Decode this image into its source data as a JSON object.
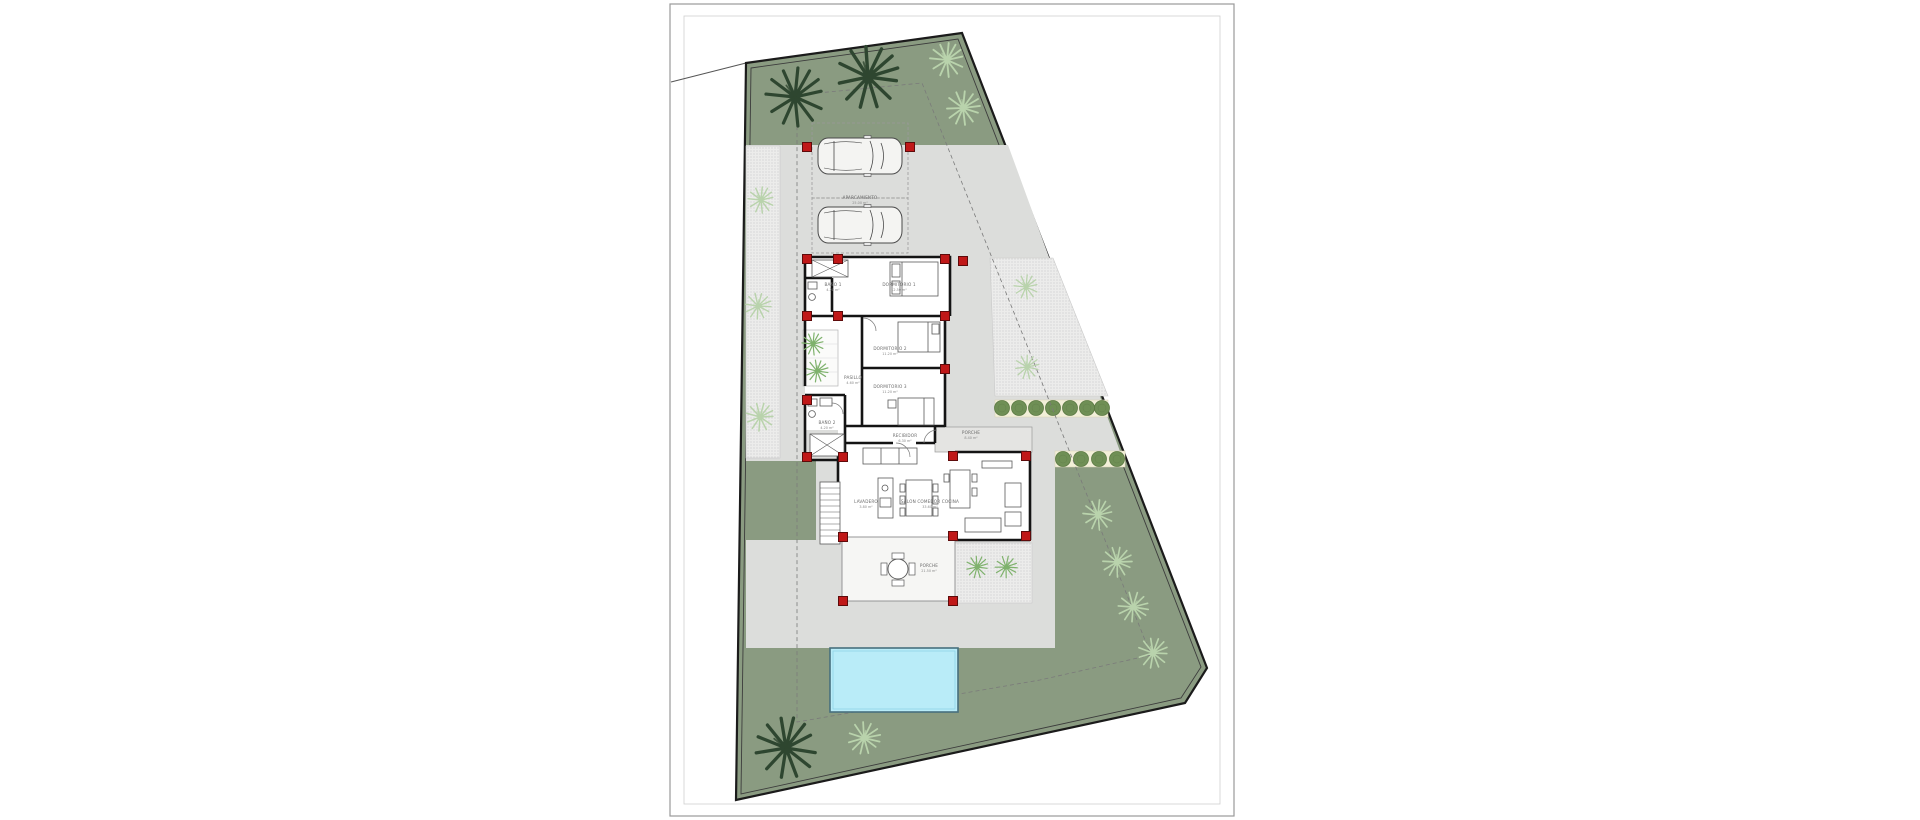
{
  "drawing": {
    "kind_label": "villa site plan",
    "colors": {
      "paper": "#ffffff",
      "lawn": "#8a9b81",
      "paved": "#dcdddb",
      "hatch_bg": "#ececeb",
      "hatch_dot": "#bdbdbd",
      "pool_water": "#b9ecf8",
      "pool_edge": "#47707e",
      "boundary": "#1b1b1b",
      "wall": "#141414",
      "column_red": "#c01818",
      "tree_dark": "#2e4630",
      "tree_light": "#b9d3ac",
      "patio_plant": "#7fb26d",
      "bush": "#6f8f55",
      "bush_band": "#f2efd8",
      "frame": "#9a9a9a"
    },
    "labels": {
      "parking": {
        "name": "APARCAMIENTO",
        "area": "25.00 m²"
      },
      "bedroom1": {
        "name": "DORMITORIO 1",
        "area": "12.50 m²"
      },
      "bath1": {
        "name": "BAÑO 1",
        "area": "4.20 m²"
      },
      "bedroom2": {
        "name": "DORMITORIO 2",
        "area": "11.20 m²"
      },
      "bedroom3": {
        "name": "DORMITORIO 3",
        "area": "11.20 m²"
      },
      "hallway": {
        "name": "PASILLO",
        "area": "4.60 m²"
      },
      "bath2": {
        "name": "BAÑO 2",
        "area": "4.20 m²"
      },
      "foyer": {
        "name": "RECIBIDOR",
        "area": "6.30 m²"
      },
      "entry_porch": {
        "name": "PORCHE",
        "area": "8.40 m²"
      },
      "laundry": {
        "name": "LAVADERO",
        "area": "3.80 m²"
      },
      "living": {
        "name": "SALON COMEDOR COCINA",
        "area": "33.60 m²"
      },
      "rear_porch": {
        "name": "PORCHE",
        "area": "21.50 m²"
      }
    }
  }
}
